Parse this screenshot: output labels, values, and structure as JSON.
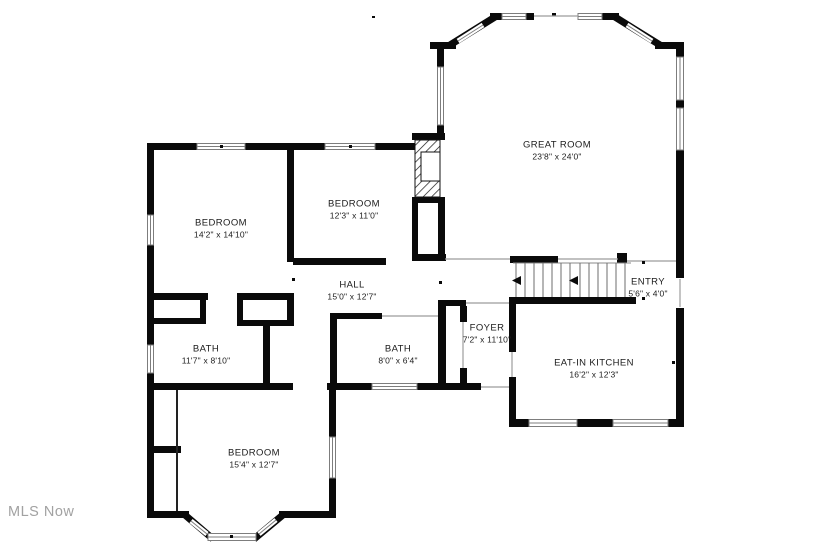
{
  "watermark": "MLS Now",
  "rooms": [
    {
      "name": "GREAT ROOM",
      "dims": "23'8\" x 24'0\""
    },
    {
      "name": "BEDROOM",
      "dims": "14'2\" x 14'10\""
    },
    {
      "name": "BEDROOM",
      "dims": "12'3\" x 11'0\""
    },
    {
      "name": "HALL",
      "dims": "15'0\" x 12'7\""
    },
    {
      "name": "ENTRY",
      "dims": "5'6\" x 4'0\""
    },
    {
      "name": "FOYER",
      "dims": "7'2\" x 11'10\""
    },
    {
      "name": "BATH",
      "dims": "11'7\" x 8'10\""
    },
    {
      "name": "BATH",
      "dims": "8'0\" x 6'4\""
    },
    {
      "name": "EAT-IN KITCHEN",
      "dims": "16'2\" x 12'3\""
    },
    {
      "name": "BEDROOM",
      "dims": "15'4\" x 12'7\""
    }
  ],
  "features": [
    "staircase",
    "fireplace",
    "bay-window-great-room",
    "bay-window-bedroom"
  ],
  "colors": {
    "wall": "#0a0a0a",
    "background": "#ffffff",
    "watermark": "#a2a2a2",
    "window_outline": "#7d7d7d"
  }
}
